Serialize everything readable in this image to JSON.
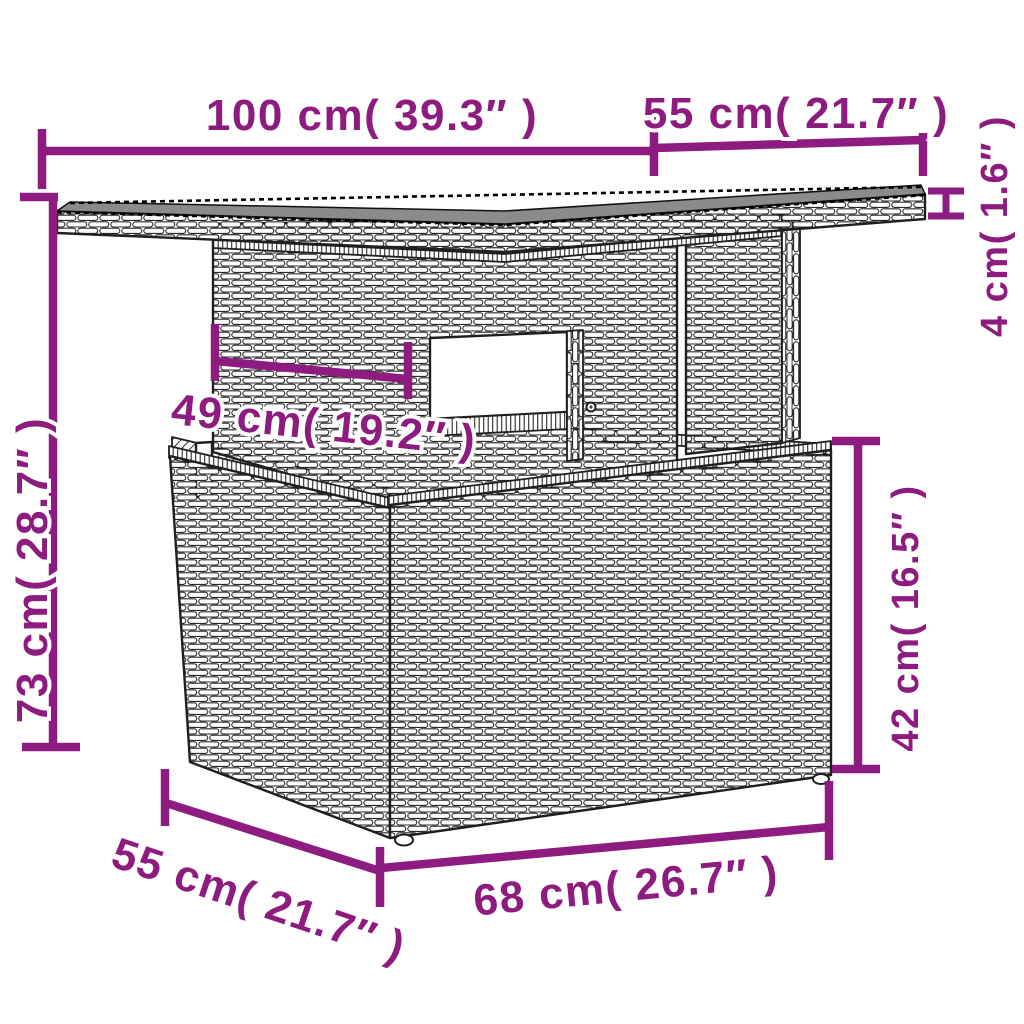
{
  "diagram": {
    "accent_color": "#8E1B80",
    "subject": "poly-rattan-lift-top-garden-table",
    "dimensions": [
      {
        "name": "tabletop-width",
        "label": "100 cm( 39.3″ )"
      },
      {
        "name": "tabletop-depth",
        "label": "55 cm( 21.7″ )"
      },
      {
        "name": "tabletop-thickness",
        "label": "4 cm( 1.6″ )"
      },
      {
        "name": "overall-height",
        "label": "73 cm( 28.7″ )"
      },
      {
        "name": "support-panel-width",
        "label": "49 cm( 19.2″ )"
      },
      {
        "name": "base-height",
        "label": "42 cm( 16.5″ )"
      },
      {
        "name": "base-depth",
        "label": "55 cm( 21.7″ )"
      },
      {
        "name": "base-width",
        "label": "68 cm( 26.7″ )"
      }
    ]
  }
}
